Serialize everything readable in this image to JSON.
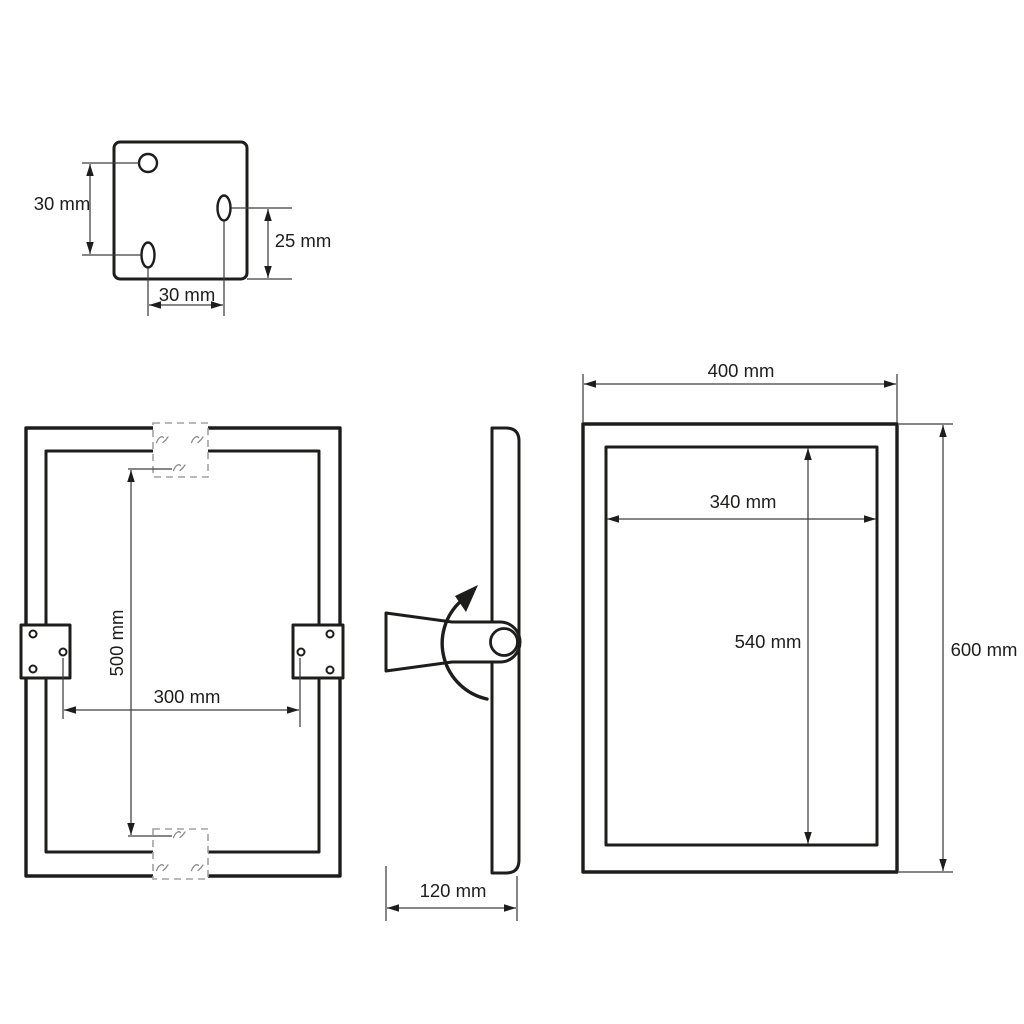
{
  "colors": {
    "line": "#1d1d1b",
    "dimension_line": "#3d3d3d",
    "dashed_outline": "#a2a2a2",
    "background": "#ffffff"
  },
  "views": {
    "bracket_detail": {
      "dim_hole_vertical_spacing": "30 mm",
      "dim_right_hole_offset": "25 mm",
      "dim_hole_horizontal_spacing": "30 mm"
    },
    "rear_view": {
      "dim_bracket_vertical_span": "500 mm",
      "dim_bracket_horizontal_span": "300 mm"
    },
    "side_view": {
      "dim_depth": "120 mm"
    },
    "front_view": {
      "dim_outer_width": "400 mm",
      "dim_outer_height": "600 mm",
      "dim_inner_width": "340 mm",
      "dim_inner_height": "540 mm"
    }
  }
}
